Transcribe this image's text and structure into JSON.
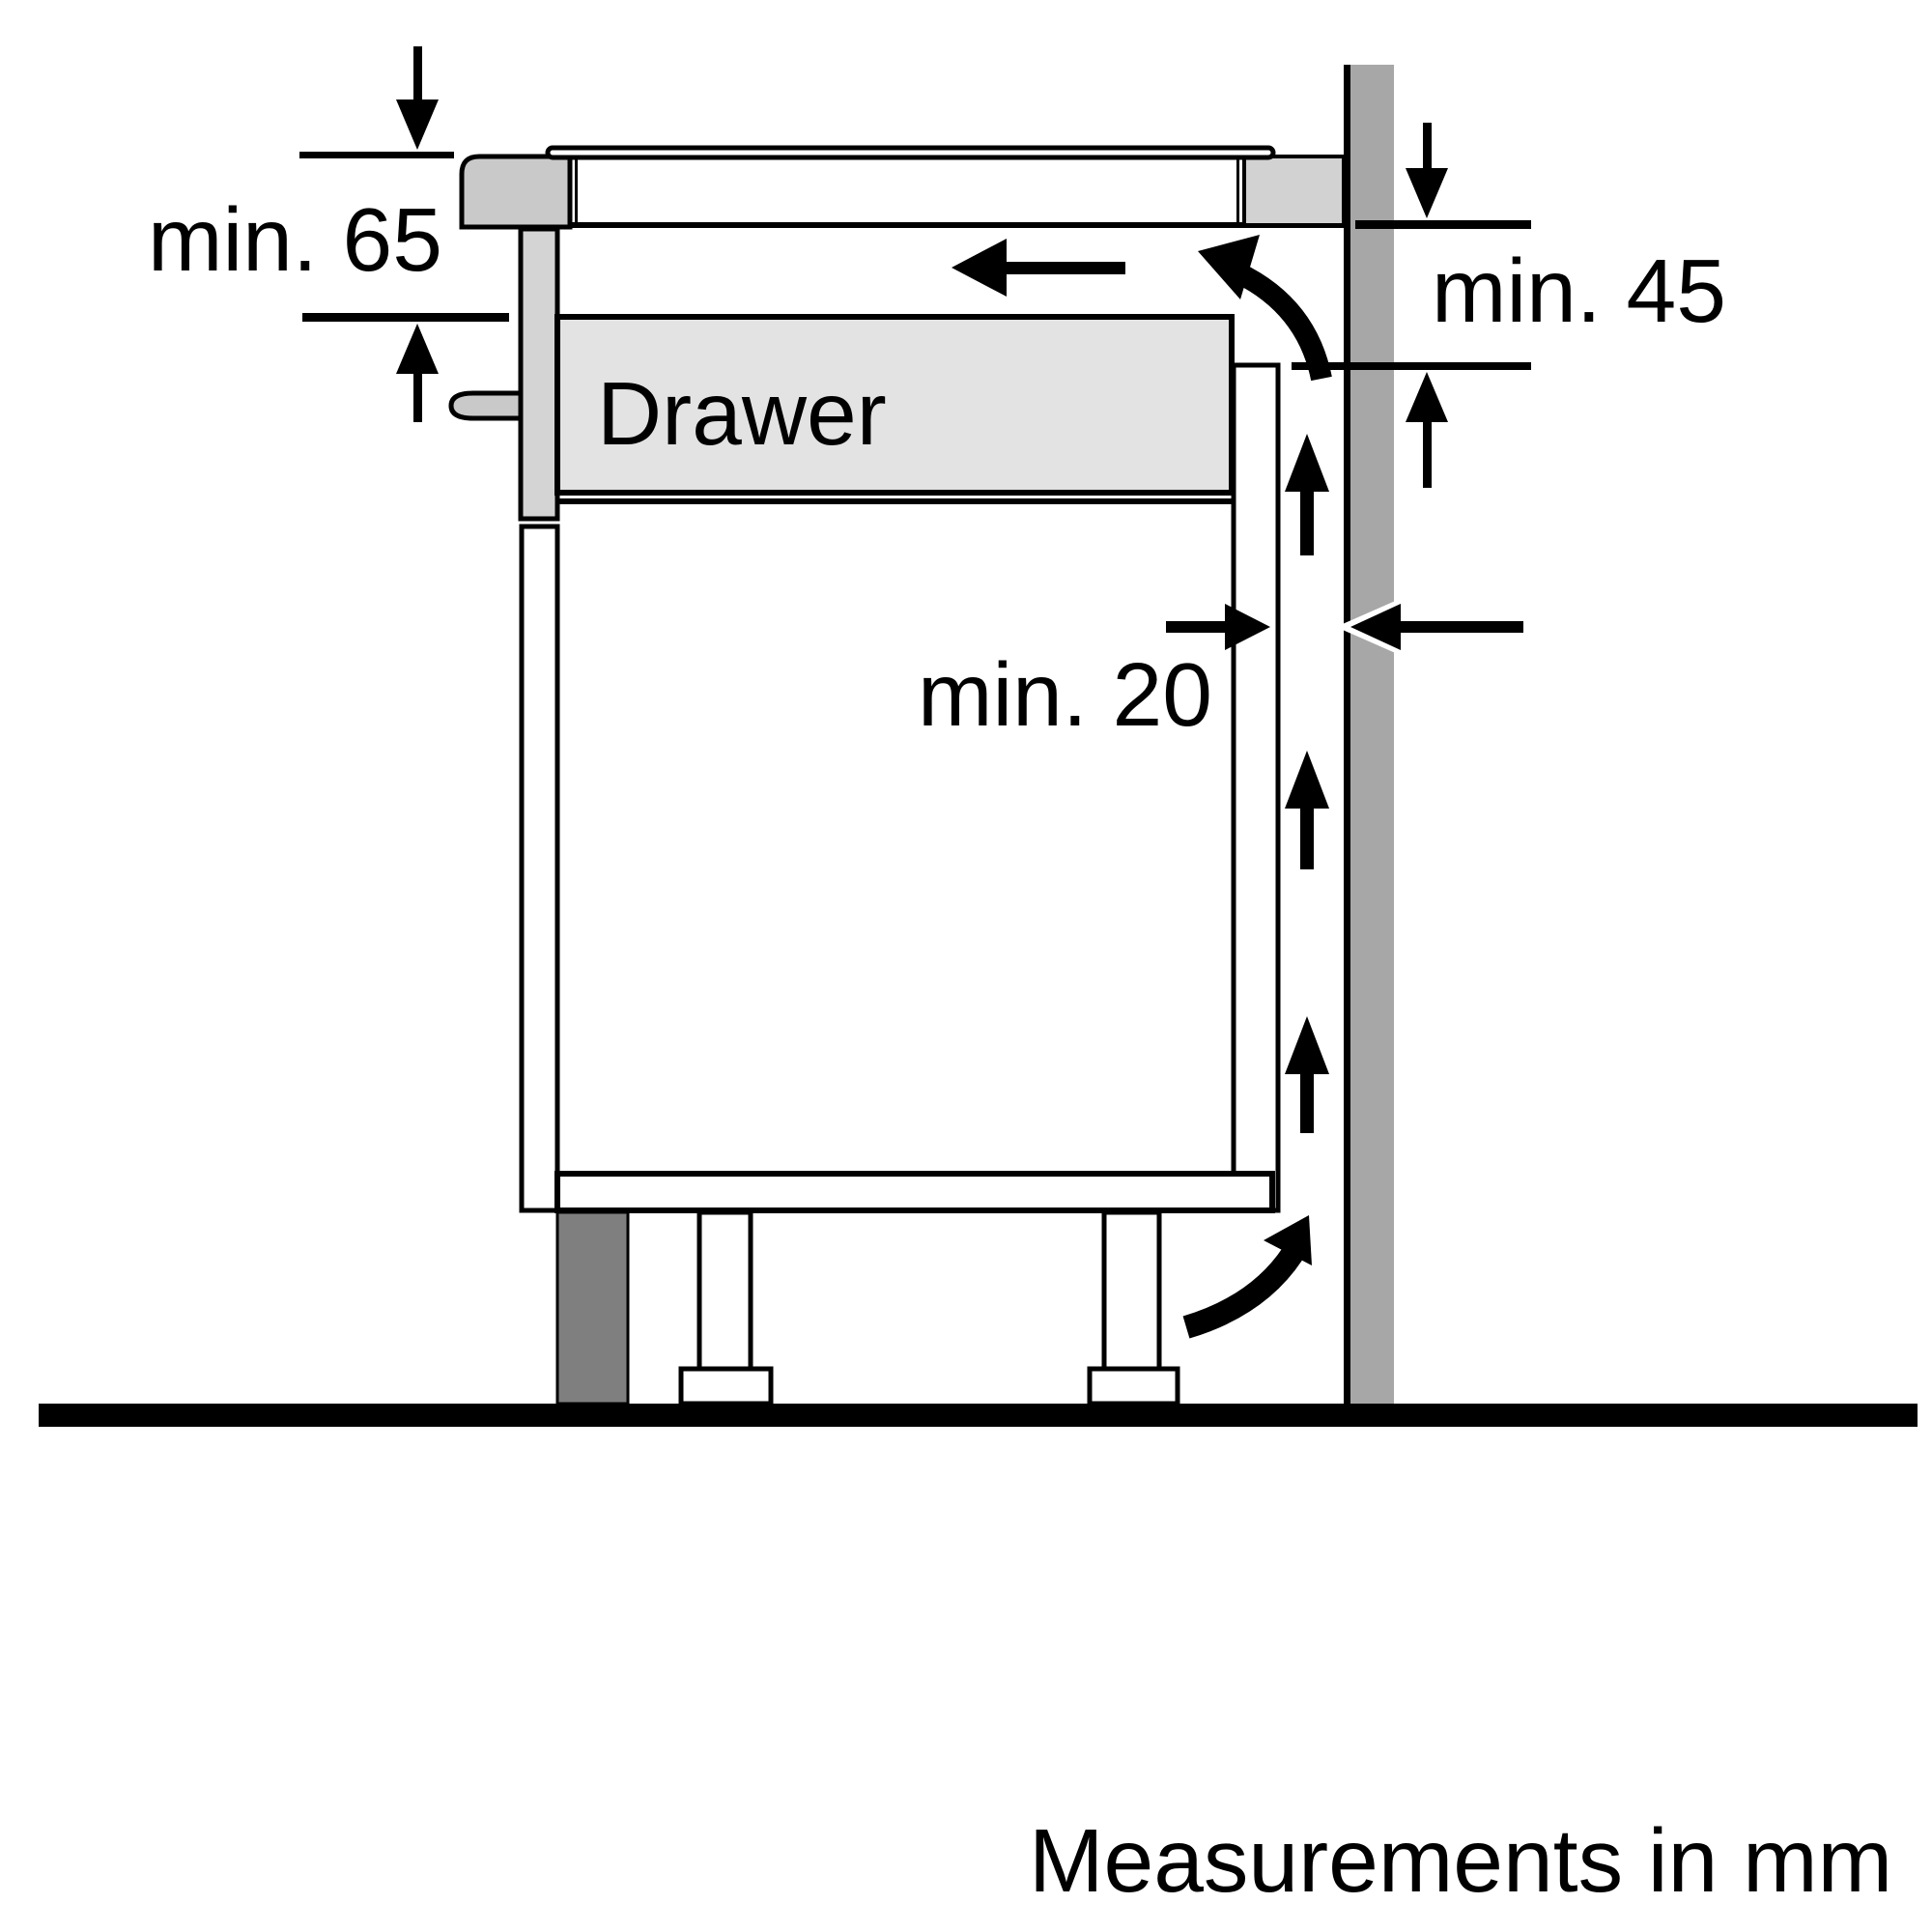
{
  "diagram": {
    "title": "Hob installation clearance side view",
    "unit_note": "Measurements in mm",
    "labels": {
      "clearance_top_front": "min. 65",
      "clearance_wall_right": "min. 45",
      "clearance_back_gap": "min. 20",
      "drawer": "Drawer",
      "footer": "Measurements in mm"
    },
    "values": {
      "clearance_top_front_mm": 65,
      "clearance_wall_right_mm": 45,
      "clearance_back_gap_mm": 20
    },
    "colors": {
      "background": "#ffffff",
      "outline": "#000000",
      "wall": "#a7a7a7",
      "hob_body": "#c9c9c9",
      "worktop_end": "#d2d2d2",
      "drawer_fill": "#e3e3e3",
      "drawer_front": "#d4d4d4",
      "handle": "#c9c9c9",
      "plinth": "#7f7f7f"
    }
  }
}
